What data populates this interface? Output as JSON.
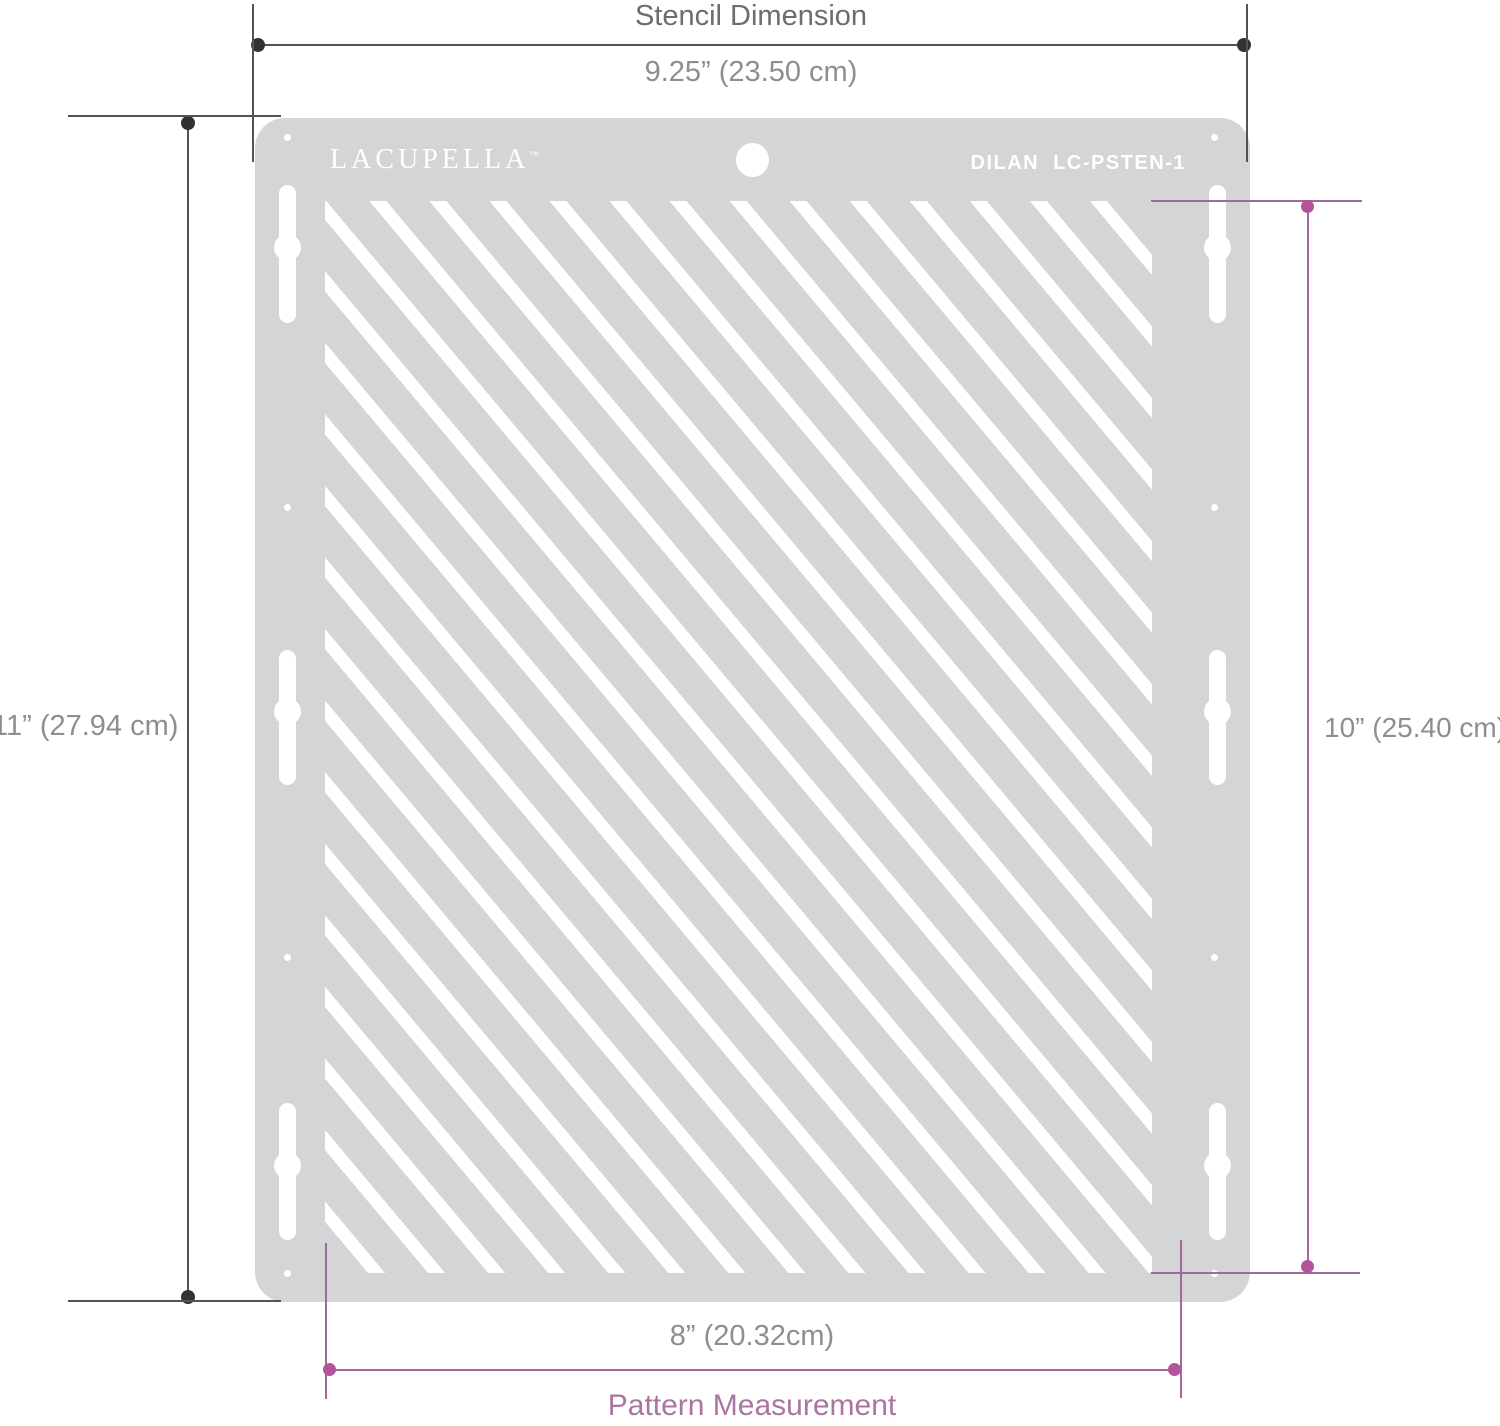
{
  "colors": {
    "stencil_gray": "#d3d5d7",
    "dimension_line_gray": "#515457",
    "endpoint_dot_dark": "#303335",
    "label_gray": "#8c8f91",
    "title_gray": "#6b6e71",
    "accent_pink_line": "#a4679b",
    "accent_pink_dot": "#b2549c",
    "accent_pink_text": "#ab74a3"
  },
  "stencil": {
    "brand": "LACUPELLA",
    "brand_tm": "™",
    "model": "DILAN  LC-PSTEN-1"
  },
  "dimensions": {
    "top": {
      "title": "Stencil Dimension",
      "value": "9.25” (23.50 cm)"
    },
    "left": {
      "value": "11” (27.94 cm)"
    },
    "right": {
      "value": "10” (25.40 cm)"
    },
    "bottom": {
      "value": "8” (20.32cm)",
      "label": "Pattern Measurement"
    }
  }
}
